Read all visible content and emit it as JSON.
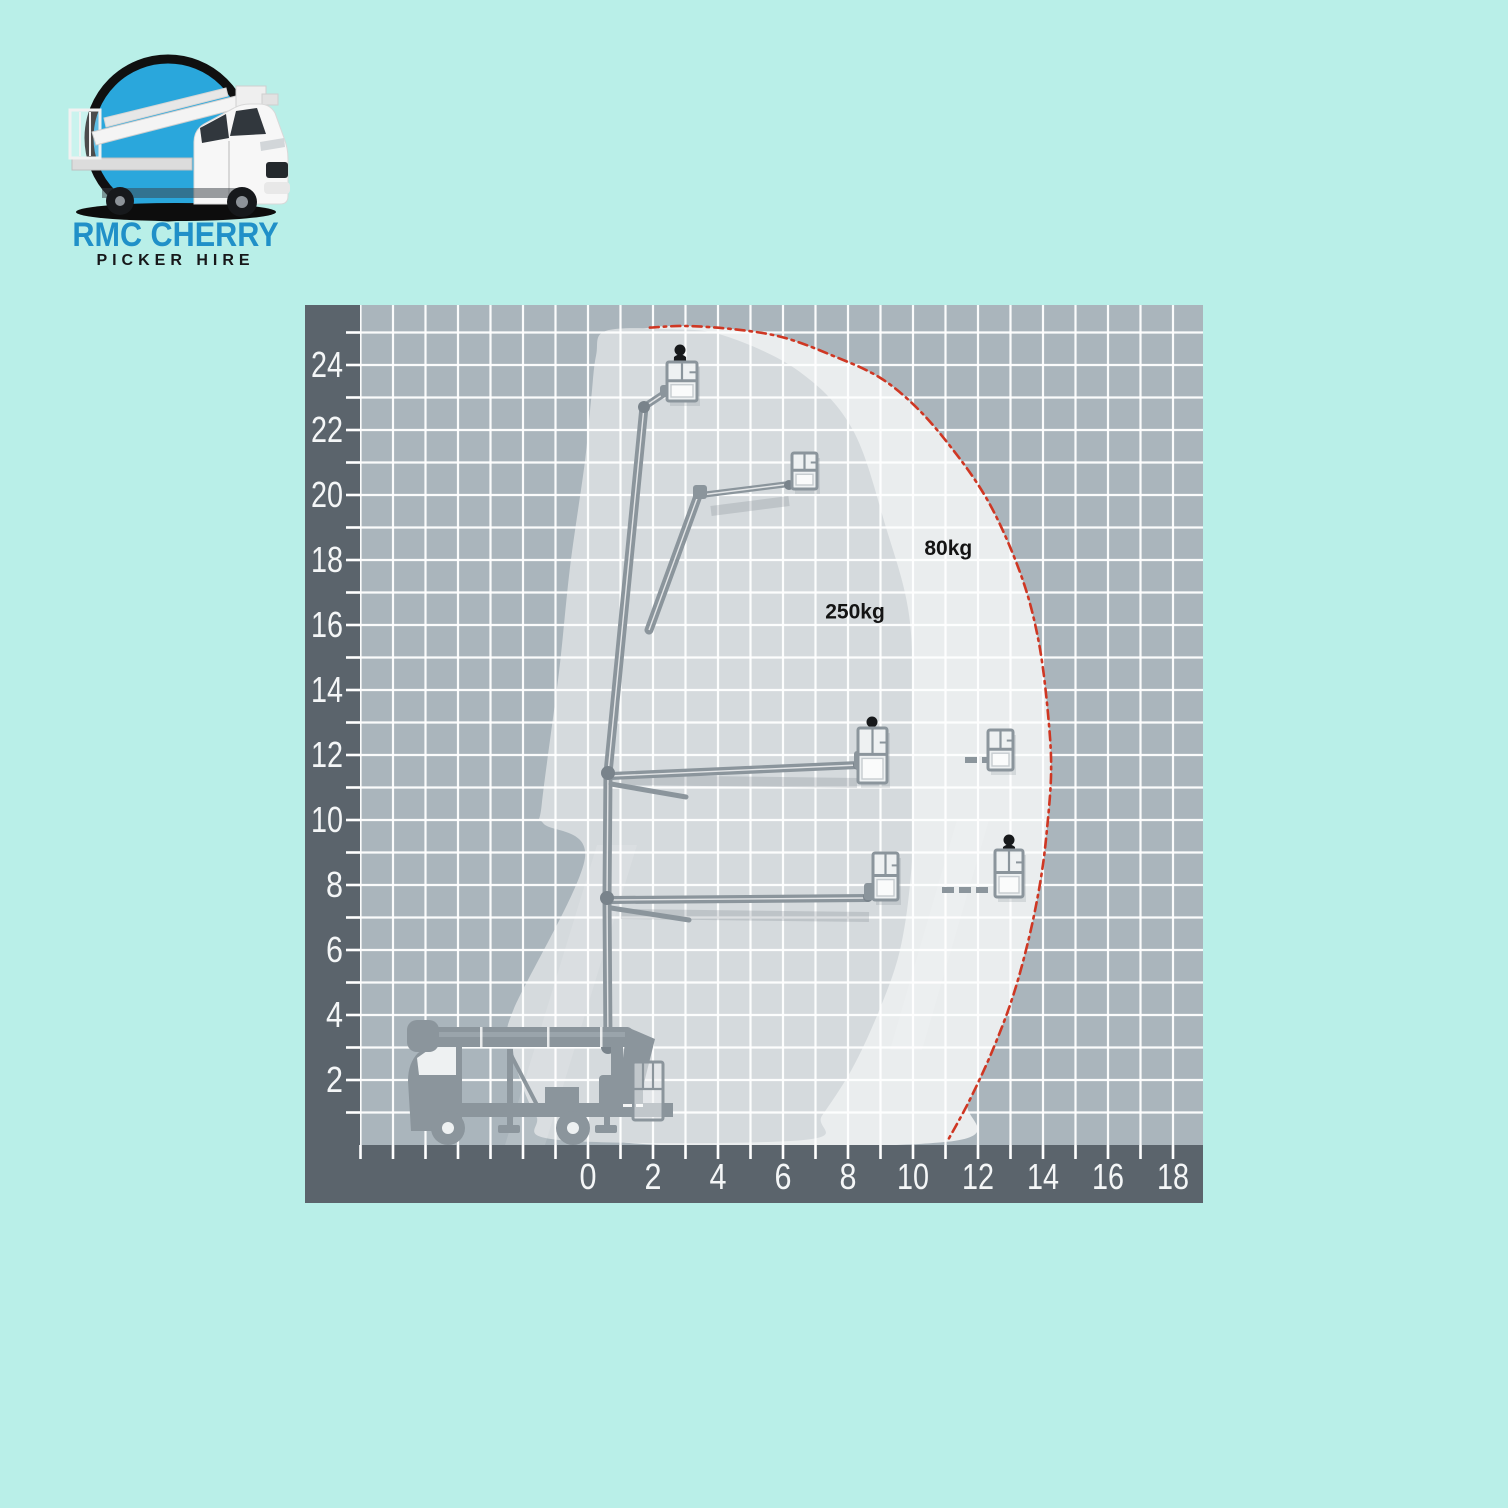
{
  "page": {
    "background_color": "#b9efe8"
  },
  "logo": {
    "title": "RMC CHERRY",
    "subtitle": "PICKER HIRE",
    "title_color": "#2090c8",
    "subtitle_color": "#17181a",
    "circle_color": "#2aa7dc",
    "ring_color": "#101010"
  },
  "chart_data": {
    "type": "area",
    "title": "Cherry picker working envelope diagram",
    "xlabel": "",
    "ylabel": "",
    "units": "m",
    "x_axis": {
      "min": -7.08,
      "max": 18.92,
      "tick_step": 1,
      "label_step": 2,
      "label_values": [
        0,
        2,
        4,
        6,
        8,
        10,
        12,
        14,
        16,
        18
      ]
    },
    "y_axis": {
      "min": 0,
      "max": 25.85,
      "tick_step": 1,
      "label_step": 2,
      "label_values": [
        2,
        4,
        6,
        8,
        10,
        12,
        14,
        16,
        18,
        20,
        22,
        24
      ]
    },
    "grid": {
      "background": "#aab5bc",
      "line_color": "#ffffff",
      "axis_band_color": "#5b646c",
      "label_color": "#f4f6f7",
      "px_per_m": 32.5
    },
    "zones": [
      {
        "name": "80kg zone",
        "label": "80kg",
        "label_pos_m": [
          10.35,
          18.15
        ],
        "fill": "#eaedee",
        "points_m": [
          [
            1.9,
            25.15
          ],
          [
            3.0,
            25.2
          ],
          [
            4.5,
            25.1
          ],
          [
            6.0,
            24.85
          ],
          [
            7.5,
            24.3
          ],
          [
            9.0,
            23.6
          ],
          [
            10.2,
            22.6
          ],
          [
            11.3,
            21.3
          ],
          [
            12.2,
            20.0
          ],
          [
            12.9,
            18.6
          ],
          [
            13.5,
            17.0
          ],
          [
            13.9,
            15.3
          ],
          [
            14.15,
            13.3
          ],
          [
            14.25,
            11.5
          ],
          [
            14.1,
            9.5
          ],
          [
            13.9,
            8.0
          ],
          [
            13.55,
            6.3
          ],
          [
            13.05,
            4.5
          ],
          [
            12.4,
            2.8
          ],
          [
            11.7,
            1.3
          ],
          [
            11.05,
            0.1
          ],
          [
            0.9,
            0.1
          ],
          [
            0.6,
            1.5
          ],
          [
            0.4,
            6.0
          ],
          [
            0.35,
            12.0
          ],
          [
            0.45,
            18.0
          ],
          [
            0.5,
            21.5
          ],
          [
            0.7,
            23.8
          ],
          [
            1.1,
            24.9
          ]
        ]
      },
      {
        "name": "250kg zone",
        "label": "250kg",
        "label_pos_m": [
          7.3,
          16.2
        ],
        "fill": "#d5dadd",
        "points_m": [
          [
            0.55,
            25.05
          ],
          [
            2.5,
            25.1
          ],
          [
            4.2,
            24.9
          ],
          [
            6.5,
            23.8
          ],
          [
            8.15,
            22.0
          ],
          [
            9.2,
            18.9
          ],
          [
            9.85,
            16.5
          ],
          [
            10.0,
            14.0
          ],
          [
            10.0,
            11.0
          ],
          [
            9.95,
            8.5
          ],
          [
            9.6,
            6.0
          ],
          [
            8.9,
            4.0
          ],
          [
            8.1,
            2.3
          ],
          [
            7.2,
            0.9
          ],
          [
            6.6,
            0.15
          ],
          [
            -0.85,
            0.15
          ],
          [
            -1.6,
            0.9
          ],
          [
            -2.15,
            2.2
          ],
          [
            -2.35,
            3.3
          ],
          [
            -2.3,
            4.15
          ],
          [
            -0.1,
            8.8
          ],
          [
            -1.38,
            9.9
          ],
          [
            -1.42,
            10.5
          ],
          [
            -0.9,
            14.5
          ],
          [
            -0.55,
            17.8
          ],
          [
            -0.1,
            21.0
          ],
          [
            0.1,
            23.0
          ],
          [
            0.25,
            24.3
          ]
        ]
      }
    ],
    "boundary": {
      "name": "maximum outreach limit",
      "color": "#cf3723",
      "style": "dash-dot",
      "points_m": [
        [
          1.9,
          25.15
        ],
        [
          3.0,
          25.2
        ],
        [
          4.5,
          25.1
        ],
        [
          6.0,
          24.85
        ],
        [
          7.5,
          24.3
        ],
        [
          9.0,
          23.6
        ],
        [
          10.2,
          22.6
        ],
        [
          11.3,
          21.3
        ],
        [
          12.2,
          20.0
        ],
        [
          12.9,
          18.6
        ],
        [
          13.5,
          17.0
        ],
        [
          13.9,
          15.3
        ],
        [
          14.15,
          13.3
        ],
        [
          14.25,
          11.5
        ],
        [
          14.1,
          9.5
        ],
        [
          13.9,
          8.0
        ],
        [
          13.55,
          6.3
        ],
        [
          13.05,
          4.5
        ],
        [
          12.4,
          2.8
        ],
        [
          11.7,
          1.3
        ],
        [
          11.05,
          0.1
        ]
      ]
    },
    "zone_label_color": "#141414"
  }
}
